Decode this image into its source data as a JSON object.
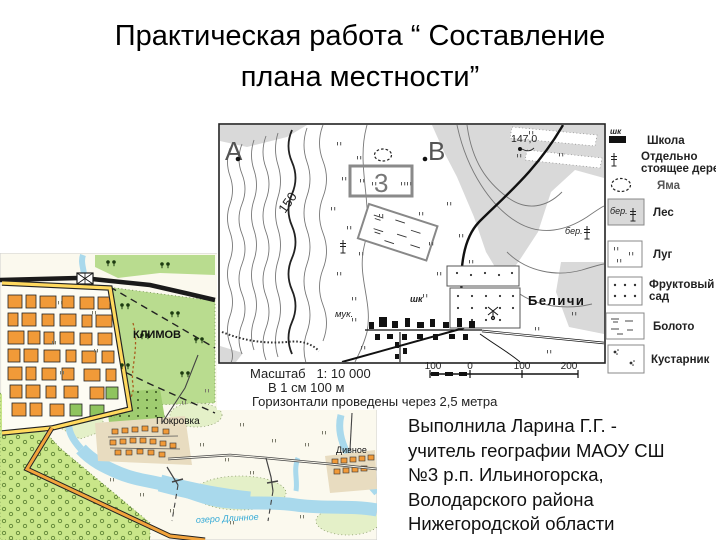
{
  "slide": {
    "title_line1": "Практическая работа “ Составление",
    "title_line2": "плана местности”",
    "credit": [
      "Выполнила Ларина Г.Г. -",
      "учитель географии МАОУ СШ",
      "№3 р.п. Ильиногорска,",
      "Володарского района",
      "Нижегородской области"
    ]
  },
  "topo_map": {
    "point_a": "А",
    "point_b": "В",
    "elevation_mark": "147,0",
    "contour_label": "150",
    "area_number": "3",
    "school_abbr": "шк",
    "mill_abbr": "мук.",
    "village_name": "Беличи",
    "forest_abbr": "бер.",
    "scale_line1": "Масштаб   1: 10 000",
    "scale_line2": "В 1 см 100 м",
    "scale_line3": "Горизонтали проведены через 2,5 метра",
    "scalebar_labels": [
      "100",
      "0",
      "100",
      "200"
    ],
    "legend": [
      {
        "symbol": "school-icon",
        "label": "Школа"
      },
      {
        "symbol": "lone-tree-icon",
        "label1": "Отдельно",
        "label2": "стоящее дерево"
      },
      {
        "symbol": "pit-icon",
        "label": "Яма"
      },
      {
        "symbol": "forest-icon",
        "label": "Лес"
      },
      {
        "symbol": "meadow-icon",
        "label": "Луг"
      },
      {
        "symbol": "orchard-icon",
        "label1": "Фруктовый",
        "label2": "сад"
      },
      {
        "symbol": "swamp-icon",
        "label": "Болото"
      },
      {
        "symbol": "shrub-icon",
        "label": "Кустарник"
      }
    ]
  },
  "colored_map": {
    "town_name": "КЛИМОВ",
    "village1_name": "Покровка",
    "village2_name": "Дивное",
    "lake_label": "озеро Длинное"
  },
  "colors": {
    "forest_green": "#b9dc8f",
    "pale_green": "#e4f0c8",
    "orchard_green": "#c9e689",
    "river_blue": "#a9d9ec",
    "building_orange": "#f19a38",
    "road_yellow": "#ffd95e",
    "village_tan": "#e8dcc0",
    "topo_gray": "#d9d9d9"
  }
}
